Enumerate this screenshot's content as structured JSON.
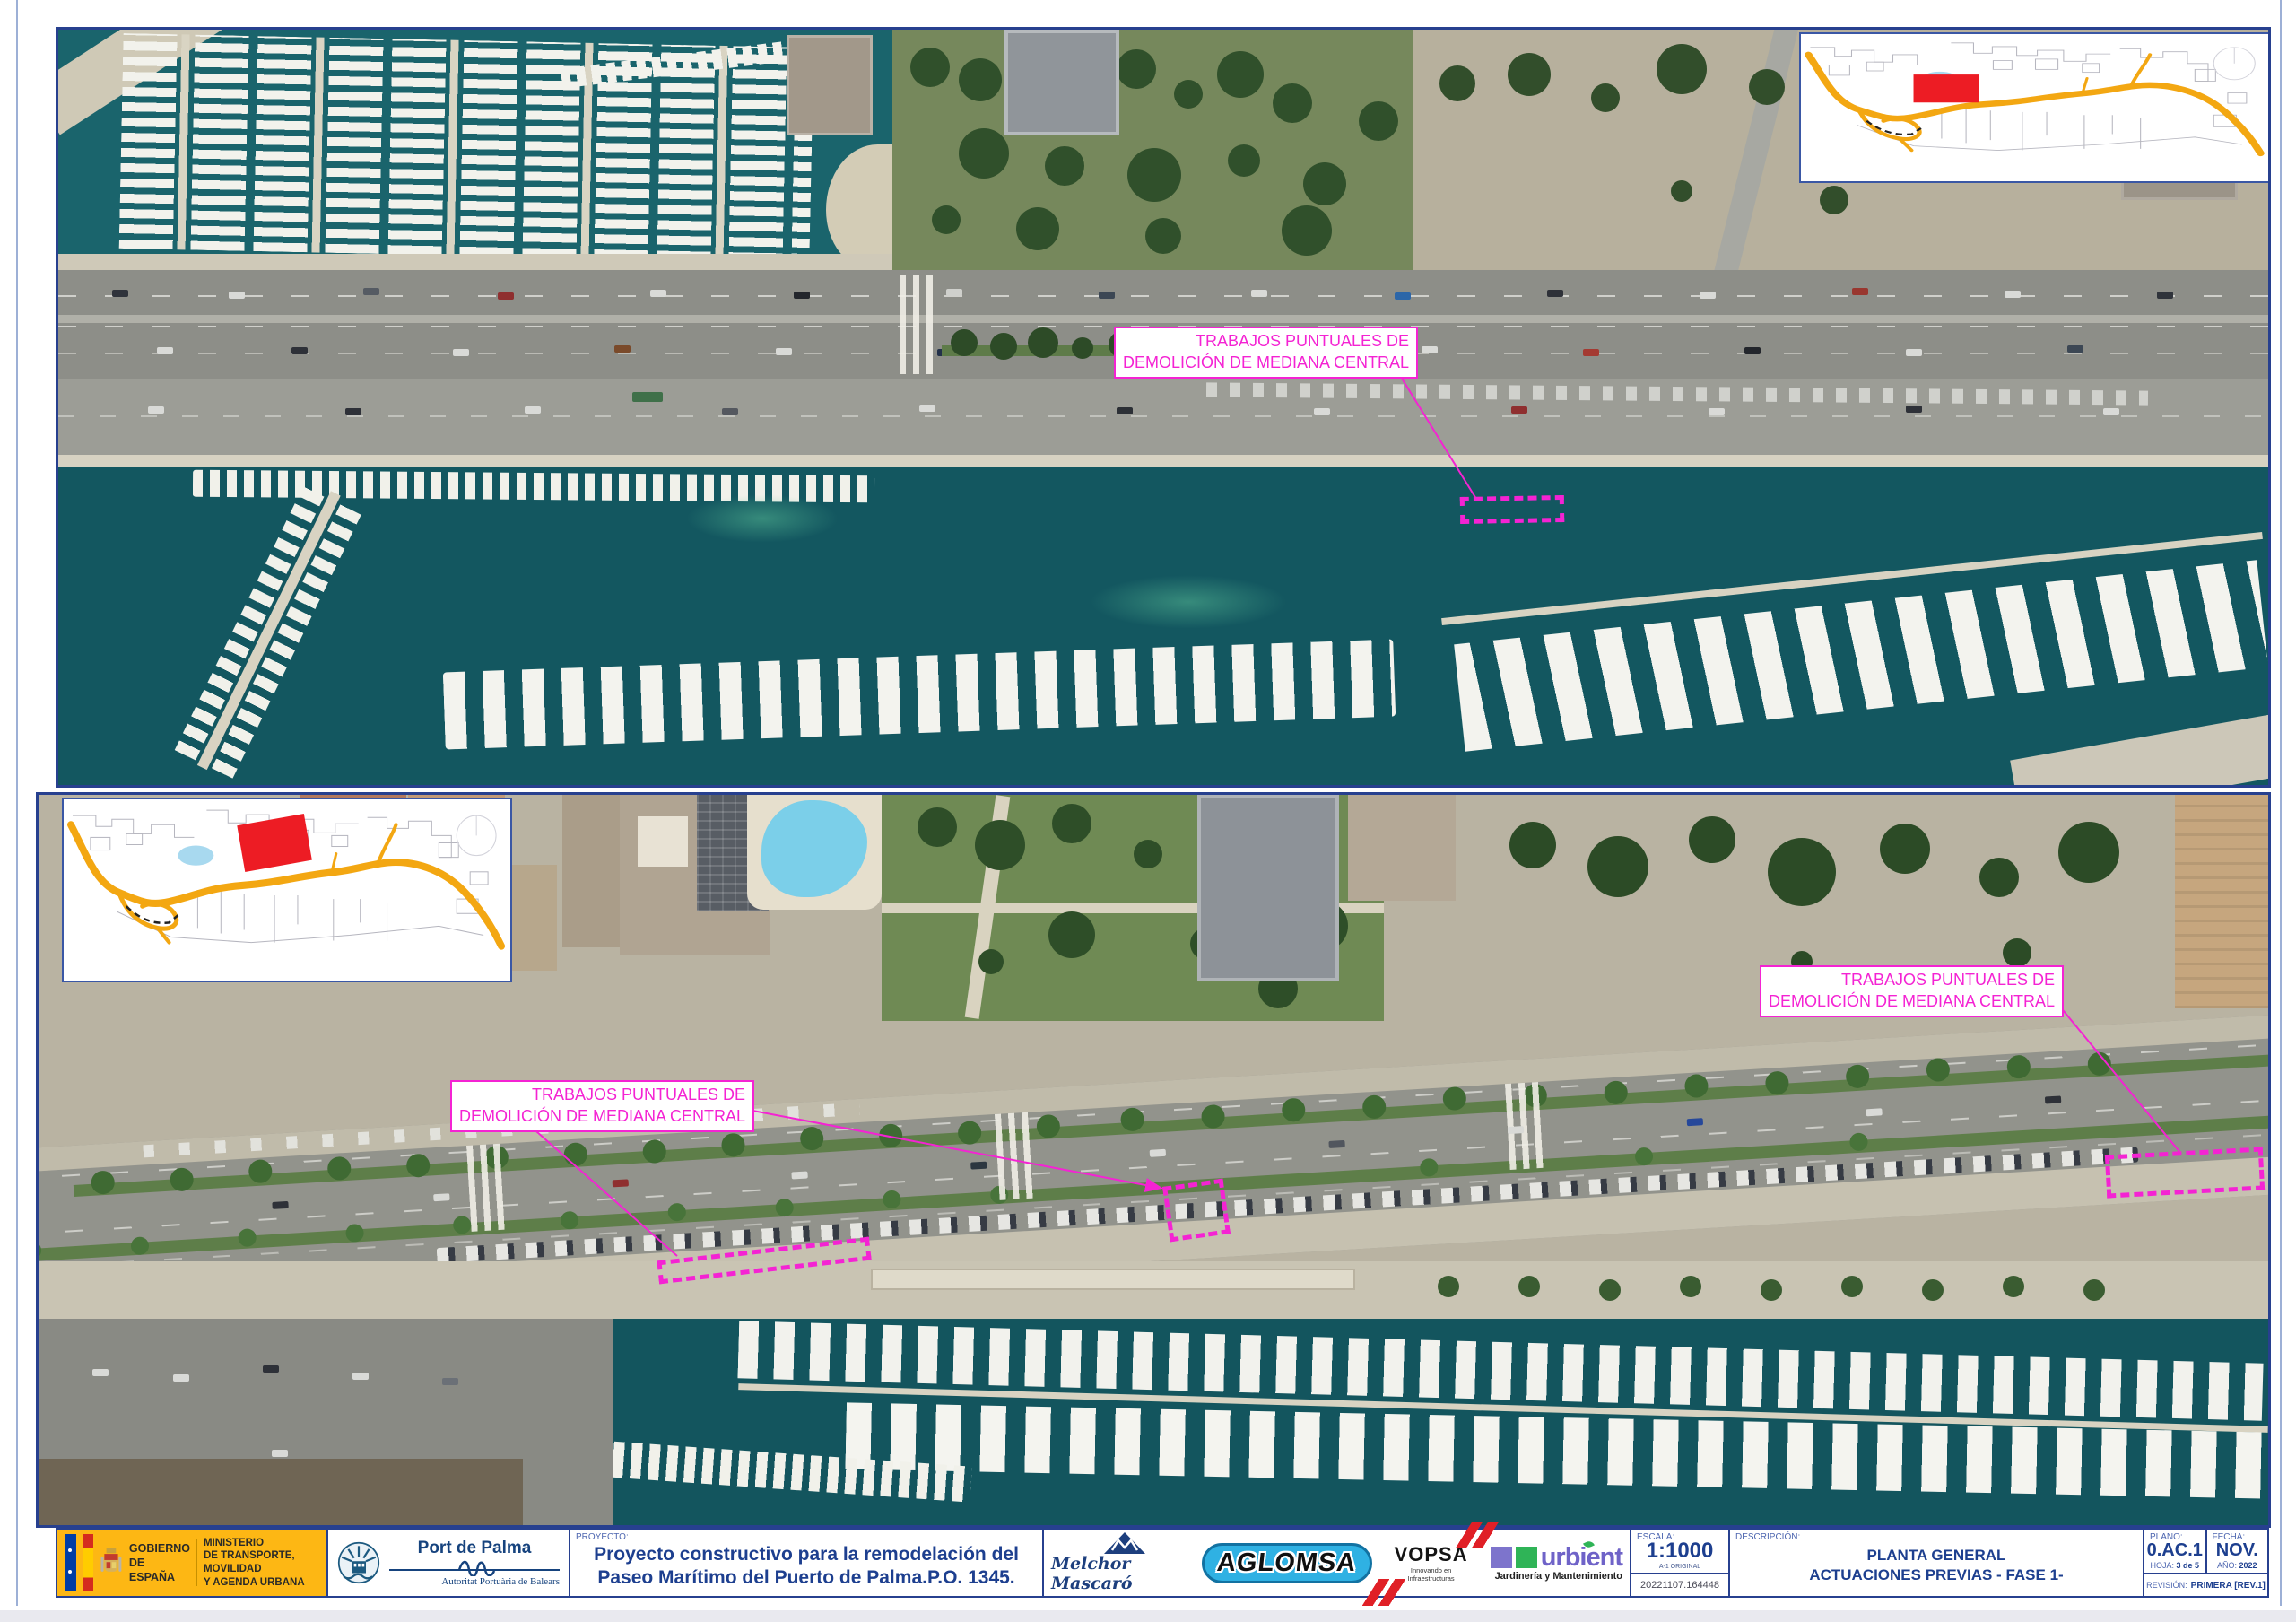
{
  "annotation": {
    "line1": "TRABAJOS PUNTUALES DE",
    "line2": "DEMOLICIÓN DE MEDIANA CENTRAL"
  },
  "title_block": {
    "gobierno_line1": "GOBIERNO",
    "gobierno_line2": "DE ESPAÑA",
    "ministerio_line1": "MINISTERIO",
    "ministerio_line2": "DE TRANSPORTE, MOVILIDAD",
    "ministerio_line3": "Y AGENDA URBANA",
    "port_name": "Port de Palma",
    "apb_name": "Autoritat Portuària de Balears",
    "proyecto_label": "PROYECTO:",
    "proyecto_line1": "Proyecto constructivo para la remodelación del",
    "proyecto_line2": "Paseo Marítimo del Puerto de Palma.P.O. 1345.",
    "melchor": "Melchor Mascaró",
    "aglomsa": "AGLOMSA",
    "vopsa": "VOPSA",
    "vopsa_tagline": "Innovando en Infraestructuras",
    "urbient": "urbient",
    "urbient_tagline": "Jardinería y Mantenimiento",
    "escala_label": "ESCALA:",
    "escala_value": "1:1000",
    "escala_note": "A-1 ORIGINAL",
    "file_number": "20221107.164448",
    "descripcion_label": "DESCRIPCIÓN:",
    "descripcion_line1": "PLANTA GENERAL",
    "descripcion_line2": "ACTUACIONES PREVIAS - FASE 1-",
    "plano_label": "PLANO:",
    "plano_value": "0.AC.1",
    "hoja_label": "HOJA:",
    "hoja_value": "3 de 5",
    "fecha_label": "FECHA:",
    "fecha_value": "NOV.",
    "ano_label": "AÑO:",
    "ano_value": "2022",
    "revision_label": "REVISIÓN:",
    "revision_value": "PRIMERA [REV.1]"
  },
  "colors": {
    "annotation_magenta": "#F423D3",
    "titleblock_navy": "#27408F",
    "ministry_yellow": "#FDB714",
    "locator_red": "#ED1C24",
    "locator_road_orange": "#F3A712"
  }
}
